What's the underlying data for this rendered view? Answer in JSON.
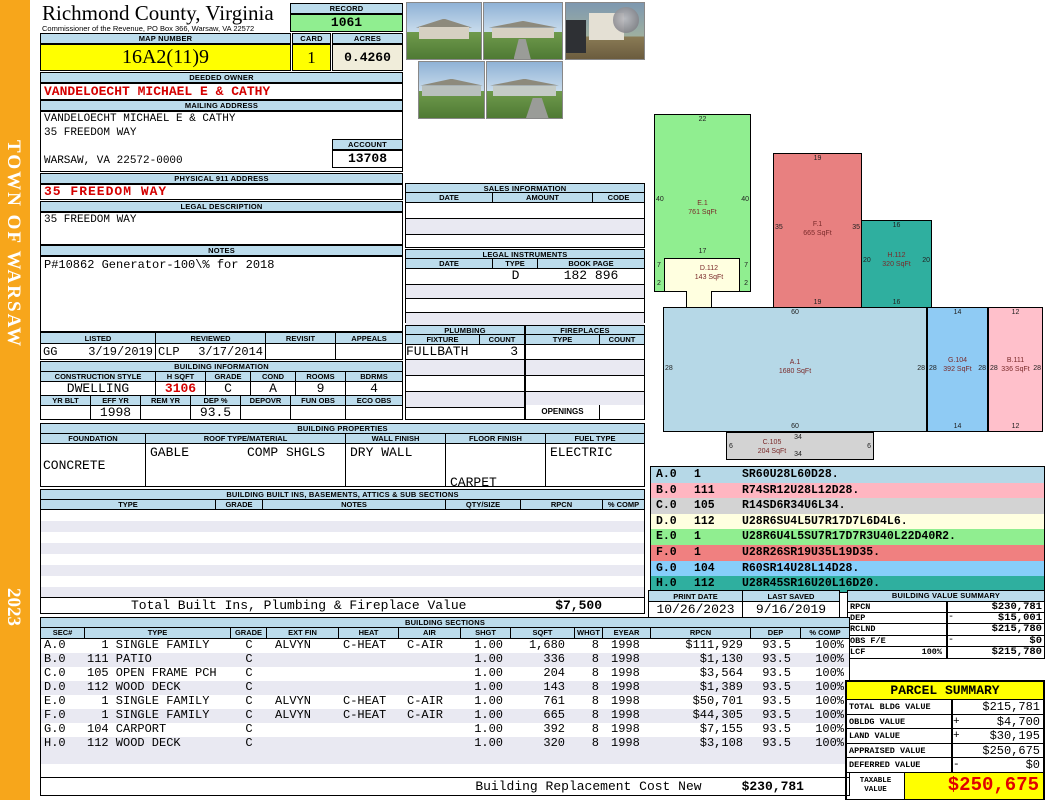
{
  "sidebar": {
    "town": "TOWN OF WARSAW",
    "year": "2023"
  },
  "colors": {
    "sidebar_bg": "#F7A61B",
    "header_bar_bg": "#BCDCEC",
    "highlight_yellow": "#FFFF00",
    "record_green": "#90EE90",
    "acres_cream": "#F0EDDA",
    "alert_red": "#D40000"
  },
  "header": {
    "county": "Richmond County, Virginia",
    "subtitle": "Commissioner of the Revenue, PO Box 366, Warsaw, VA 22572",
    "record_label": "RECORD",
    "record_value": "1061",
    "map_number_label": "MAP NUMBER",
    "map_number": "16A2(11)9",
    "card_label": "CARD",
    "card": "1",
    "acres_label": "ACRES",
    "acres": "0.4260"
  },
  "owner": {
    "deeded_owner_label": "DEEDED OWNER",
    "deeded_owner": "VANDELOECHT MICHAEL E & CATHY",
    "mailing_address_label": "MAILING ADDRESS",
    "mailing_lines": [
      "VANDELOECHT MICHAEL E & CATHY",
      "35 FREEDOM WAY",
      "",
      "WARSAW, VA 22572-0000"
    ],
    "account_label": "ACCOUNT",
    "account": "13708",
    "physical_address_label": "PHYSICAL 911 ADDRESS",
    "physical_address": "35 FREEDOM WAY",
    "legal_description_label": "LEGAL DESCRIPTION",
    "legal_description": "35 FREEDOM WAY",
    "notes_label": "NOTES",
    "notes": "P#10862 Generator-100\\% for 2018"
  },
  "review": {
    "listed_label": "LISTED",
    "reviewed_label": "REVIEWED",
    "revisit_label": "REVISIT",
    "appeals_label": "APPEALS",
    "listed_by": "GG",
    "listed_date": "3/19/2019",
    "reviewed_by": "CLP",
    "reviewed_date": "3/17/2014",
    "revisit": "",
    "appeals": ""
  },
  "building_info": {
    "title": "BUILDING INFORMATION",
    "headers1": [
      "CONSTRUCTION STYLE",
      "H SQFT",
      "GRADE",
      "COND",
      "ROOMS",
      "BDRMS"
    ],
    "values1": [
      "DWELLING",
      "3106",
      "C",
      "A",
      "9",
      "4"
    ],
    "headers2": [
      "YR BLT",
      "EFF YR",
      "REM YR",
      "DEP %",
      "DEPOVR",
      "FUN OBS",
      "ECO OBS"
    ],
    "values2": [
      "",
      "1998",
      "",
      "93.5",
      "",
      "",
      ""
    ]
  },
  "building_properties": {
    "title": "BUILDING PROPERTIES",
    "headers": [
      "FOUNDATION",
      "ROOF TYPE/MATERIAL",
      "WALL FINISH",
      "FLOOR FINISH",
      "FUEL TYPE"
    ],
    "foundation": "CONCRETE",
    "roof_type": "GABLE",
    "roof_material": "COMP SHGLS",
    "wall_finish": "DRY WALL",
    "floor_finish_lines": [
      "CARPET",
      "TILE"
    ],
    "fuel_type": "ELECTRIC"
  },
  "built_ins": {
    "title": "BUILDING BUILT INS, BASEMENTS, ATTICS & SUB SECTIONS",
    "headers": [
      "TYPE",
      "GRADE",
      "NOTES",
      "QTY/SIZE",
      "RPCN",
      "% COMP"
    ],
    "total_label": "Total Built Ins, Plumbing & Fireplace Value",
    "total_value": "$7,500"
  },
  "sales": {
    "title": "SALES INFORMATION",
    "headers": [
      "DATE",
      "AMOUNT",
      "CODE"
    ]
  },
  "legal_instruments": {
    "title": "LEGAL INSTRUMENTS",
    "headers": [
      "DATE",
      "TYPE",
      "BOOK PAGE"
    ],
    "rows": [
      {
        "date": "",
        "type": "D",
        "book_page": "182 896"
      }
    ]
  },
  "plumbing": {
    "title": "PLUMBING",
    "headers": [
      "FIXTURE",
      "COUNT"
    ],
    "rows": [
      {
        "fixture": "FULLBATH",
        "count": "3"
      }
    ]
  },
  "fireplaces": {
    "title": "FIREPLACES",
    "headers": [
      "TYPE",
      "COUNT"
    ],
    "openings_label": "OPENINGS"
  },
  "print_info": {
    "print_date_label": "PRINT DATE",
    "print_date": "10/26/2023",
    "last_saved_label": "LAST SAVED",
    "last_saved": "9/16/2019"
  },
  "building_value_summary": {
    "title": "BUILDING VALUE SUMMARY",
    "rows": [
      {
        "label": "RPCN",
        "pct": "",
        "op": "",
        "value": "$230,781"
      },
      {
        "label": "DEP",
        "pct": "",
        "op": "-",
        "value": "$15,001"
      },
      {
        "label": "RCLND",
        "pct": "",
        "op": "",
        "value": "$215,780"
      },
      {
        "label": "OBS F/E",
        "pct": "",
        "op": "-",
        "value": "$0"
      },
      {
        "label": "LCF",
        "pct": "100%",
        "op": "",
        "value": "$215,780"
      }
    ]
  },
  "parcel_summary": {
    "title": "PARCEL SUMMARY",
    "rows": [
      {
        "label": "TOTAL BLDG VALUE",
        "op": "",
        "value": "$215,781"
      },
      {
        "label": "OBLDG VALUE",
        "op": "+",
        "value": "$4,700"
      },
      {
        "label": "LAND VALUE",
        "op": "+",
        "value": "$30,195"
      },
      {
        "label": "APPRAISED VALUE",
        "op": "",
        "value": "$250,675"
      },
      {
        "label": "DEFERRED VALUE",
        "op": "-",
        "value": "$0"
      }
    ],
    "taxable_label_line1": "TAXABLE",
    "taxable_label_line2": "VALUE",
    "taxable_value": "$250,675"
  },
  "building_sections": {
    "title": "BUILDING SECTIONS",
    "headers": [
      "SEC#",
      "TYPE",
      "GRADE",
      "EXT FIN",
      "HEAT",
      "AIR",
      "SHGT",
      "SQFT",
      "WHGT",
      "EYEAR",
      "RPCN",
      "DEP",
      "% COMP"
    ],
    "rows": [
      [
        "A.0",
        "  1 SINGLE FAMILY",
        "C",
        "ALVYN",
        "C-HEAT",
        "C-AIR",
        "1.00",
        "1,680",
        "8",
        "1998",
        "$111,929",
        "93.5",
        "100%"
      ],
      [
        "B.0",
        "111 PATIO",
        "C",
        "",
        "",
        "",
        "1.00",
        "336",
        "8",
        "1998",
        "$1,130",
        "93.5",
        "100%"
      ],
      [
        "C.0",
        "105 OPEN FRAME PCH",
        "C",
        "",
        "",
        "",
        "1.00",
        "204",
        "8",
        "1998",
        "$3,564",
        "93.5",
        "100%"
      ],
      [
        "D.0",
        "112 WOOD DECK",
        "C",
        "",
        "",
        "",
        "1.00",
        "143",
        "8",
        "1998",
        "$1,389",
        "93.5",
        "100%"
      ],
      [
        "E.0",
        "  1 SINGLE FAMILY",
        "C",
        "ALVYN",
        "C-HEAT",
        "C-AIR",
        "1.00",
        "761",
        "8",
        "1998",
        "$50,701",
        "93.5",
        "100%"
      ],
      [
        "F.0",
        "  1 SINGLE FAMILY",
        "C",
        "ALVYN",
        "C-HEAT",
        "C-AIR",
        "1.00",
        "665",
        "8",
        "1998",
        "$44,305",
        "93.5",
        "100%"
      ],
      [
        "G.0",
        "104 CARPORT",
        "C",
        "",
        "",
        "",
        "1.00",
        "392",
        "8",
        "1998",
        "$7,155",
        "93.5",
        "100%"
      ],
      [
        "H.0",
        "112 WOOD DECK",
        "C",
        "",
        "",
        "",
        "1.00",
        "320",
        "8",
        "1998",
        "$3,108",
        "93.5",
        "100%"
      ]
    ],
    "replacement_label": "Building Replacement Cost New",
    "replacement_value": "$230,781"
  },
  "sketch": {
    "legend": [
      {
        "sec": "A.0",
        "code": "1",
        "trace": "SR60U28L60D28.",
        "color": "#B6D8E7"
      },
      {
        "sec": "B.0",
        "code": "111",
        "trace": "R74SR12U28L12D28.",
        "color": "#FFB6C1"
      },
      {
        "sec": "C.0",
        "code": "105",
        "trace": "R14SD6R34U6L34.",
        "color": "#D3D3D3"
      },
      {
        "sec": "D.0",
        "code": "112",
        "trace": "U28R6SU4L5U7R17D7L6D4L6.",
        "color": "#FFFFE0"
      },
      {
        "sec": "E.0",
        "code": "1",
        "trace": "U28R6U4L5SU7R17D7R3U40L22D40R2.",
        "color": "#90EE90"
      },
      {
        "sec": "F.0",
        "code": "1",
        "trace": "U28R26SR19U35L19D35.",
        "color": "#F08080"
      },
      {
        "sec": "G.0",
        "code": "104",
        "trace": "R60SR14U28L14D28.",
        "color": "#87CEFA"
      },
      {
        "sec": "H.0",
        "code": "112",
        "trace": "U28R45SR16U20L16D20.",
        "color": "#2FAF9F"
      }
    ],
    "shapes": [
      {
        "name": "E.1",
        "sqft": "761 SqFt",
        "color": "#90EE90",
        "dims": {
          "top": "22",
          "left": "40",
          "right": "40"
        }
      },
      {
        "name": "D.112",
        "sqft": "143 SqFt",
        "color": "#FFFFE0",
        "dims": {
          "top": "17",
          "left": "7",
          "right": "7",
          "bl": "2",
          "br": "2"
        }
      },
      {
        "name": "F.1",
        "sqft": "665 SqFt",
        "color": "#E88080",
        "dims": {
          "top": "19",
          "left": "35",
          "right": "35",
          "bottom": "19"
        }
      },
      {
        "name": "H.112",
        "sqft": "320 SqFt",
        "color": "#2FAF9F",
        "dims": {
          "top": "16",
          "left": "20",
          "right": "20",
          "bottom": "16"
        }
      },
      {
        "name": "A.1",
        "sqft": "1680 SqFt",
        "color": "#B6D8E7",
        "dims": {
          "top": "60",
          "left": "28",
          "right": "28",
          "bottom": "60"
        }
      },
      {
        "name": "G.104",
        "sqft": "392 SqFt",
        "color": "#8FCBF4",
        "dims": {
          "top": "14",
          "left": "28",
          "right": "28",
          "bottom": "14"
        }
      },
      {
        "name": "B.111",
        "sqft": "336 SqFt",
        "color": "#FFC0CB",
        "dims": {
          "top": "12",
          "left": "28",
          "right": "28",
          "bottom": "12"
        }
      },
      {
        "name": "C.105",
        "sqft": "204 SqFt",
        "color": "#D3D3D3",
        "dims": {
          "top": "34",
          "left": "6",
          "right": "6",
          "bottom": "34"
        }
      }
    ]
  }
}
